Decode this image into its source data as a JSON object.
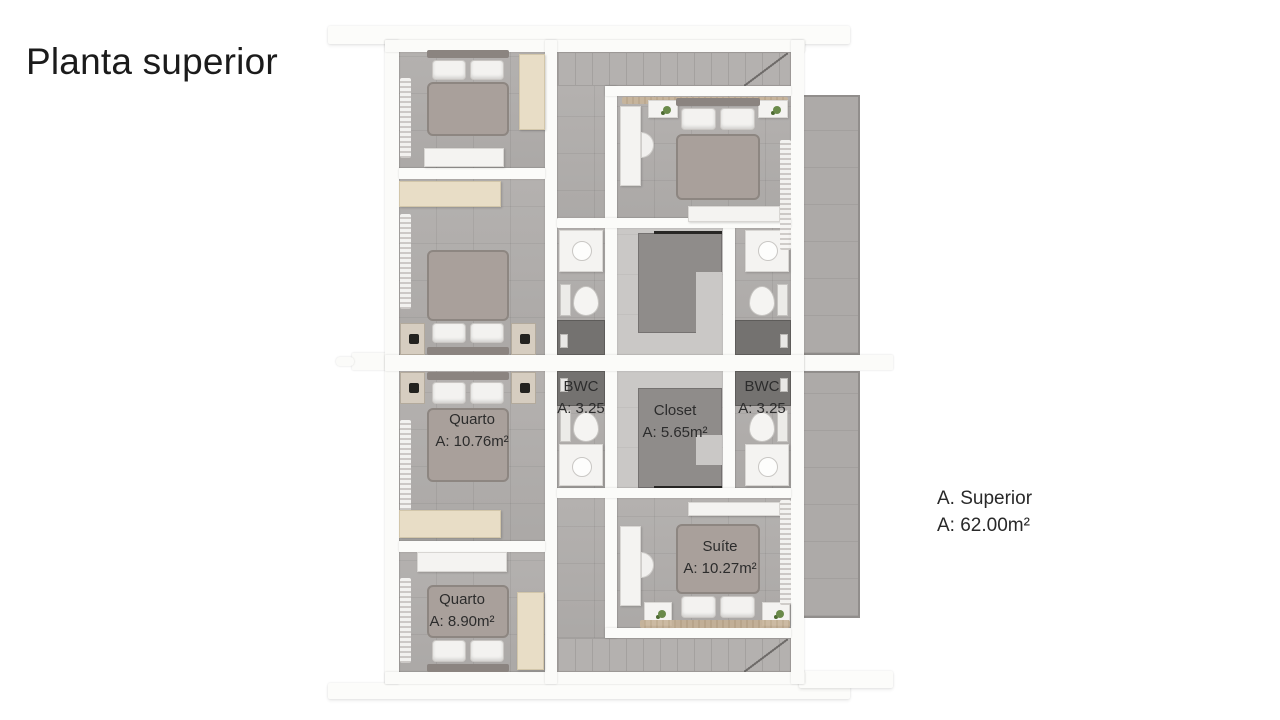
{
  "title": "Planta superior",
  "plan": {
    "rooms": {
      "quarto_upper": {
        "name": "Quarto",
        "area": "A: 10.76m²"
      },
      "bwc_left": {
        "name": "BWC",
        "area": "A: 3.25"
      },
      "closet": {
        "name": "Closet",
        "area": "A: 5.65m²"
      },
      "bwc_right": {
        "name": "BWC",
        "area": "A: 3.25"
      },
      "suite": {
        "name": "Suíte",
        "area": "A: 10.27m²"
      },
      "quarto_lower": {
        "name": "Quarto",
        "area": "A: 8.90m²"
      }
    },
    "summary": {
      "line1": "A. Superior",
      "line2": "A: 62.00m²"
    }
  },
  "colors": {
    "background": "#ffffff",
    "wall": "#fbfbf9",
    "floor_gray": "#b1aeac",
    "floor_light": "#cac8c6",
    "stair_void": "#8f8c8a",
    "furniture_beige": "#e8ddc6",
    "furniture_white": "#f4f3f1",
    "text": "#2c2c2c"
  }
}
